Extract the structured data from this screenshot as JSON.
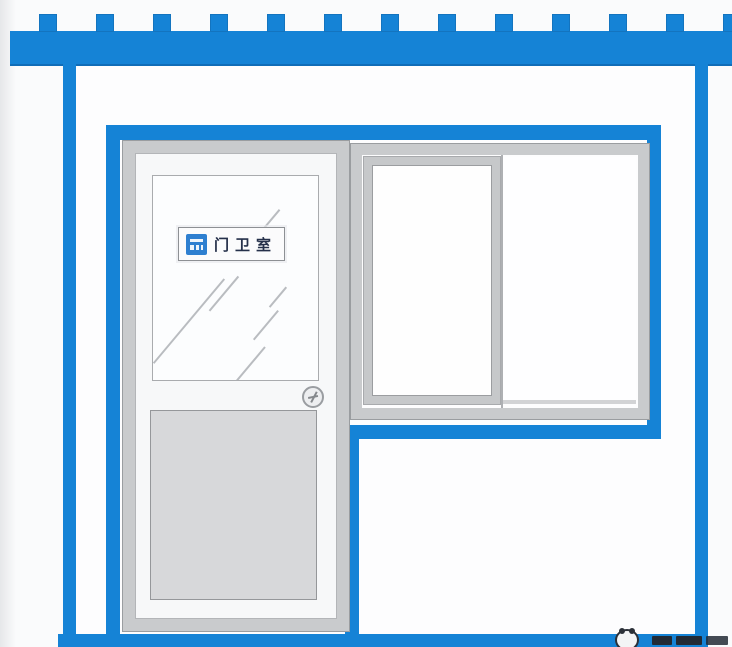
{
  "scene": {
    "description": "Illustration of a blue and white construction-site guard room facade",
    "colors": {
      "accent_blue": "#1583d6",
      "logo_blue": "#2e7fd0",
      "frame_gray": "#c9cbcd",
      "frame_gray_dark": "#9a9da0",
      "door_panel_gray": "#d7d8da",
      "wall_white": "#fdfdfe",
      "sign_text_color": "#25304a",
      "watermark_dark": "#2b3038"
    }
  },
  "roof": {
    "teeth": {
      "count": 13,
      "start": 39,
      "pitch": 57,
      "width": 18,
      "height": 18
    }
  },
  "door": {
    "sign": {
      "logo_icon": "company-logo-icon",
      "text": "门卫室"
    },
    "knob_icon": "door-knob"
  },
  "window": {
    "panes": 2
  },
  "watermark": {
    "icon": "panda-logo-icon",
    "text": ""
  }
}
